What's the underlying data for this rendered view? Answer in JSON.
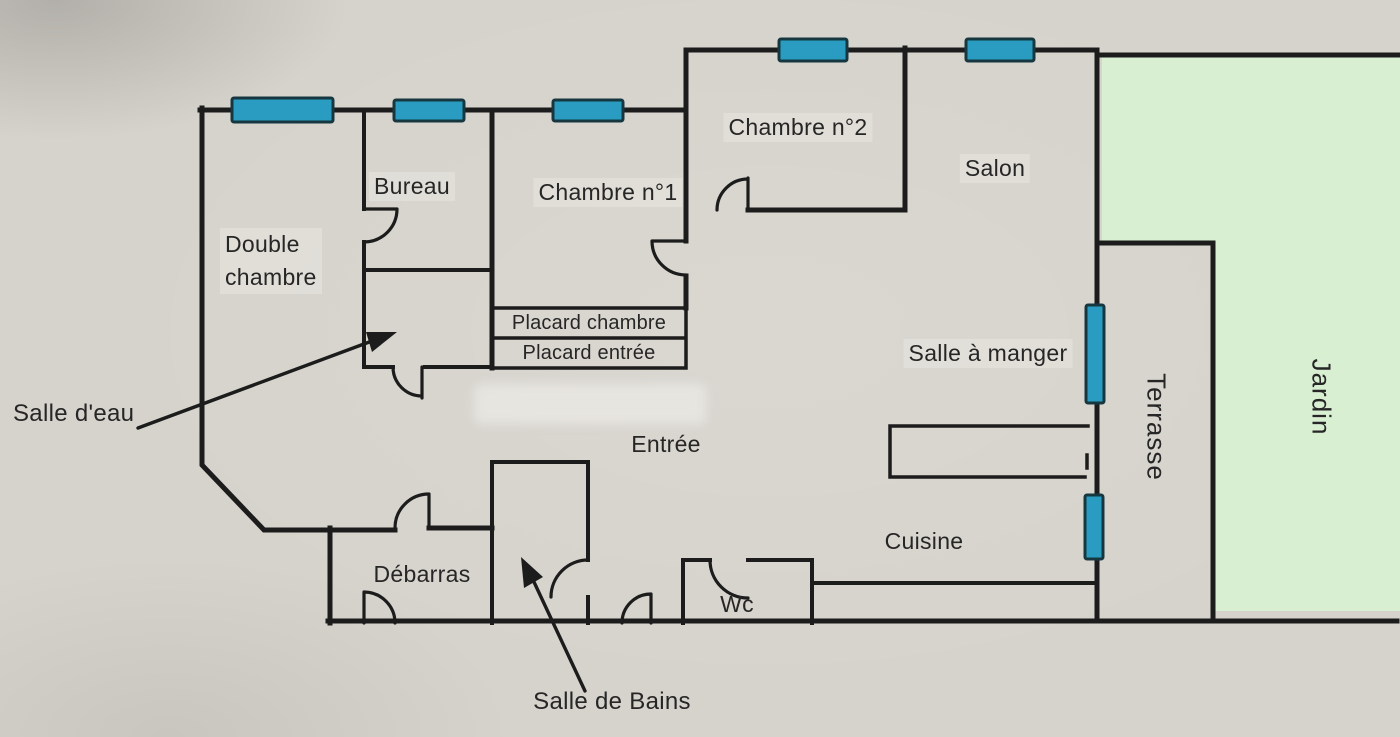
{
  "plan": {
    "rooms": {
      "double_chambre_line1": "Double",
      "double_chambre_line2": "chambre",
      "bureau": "Bureau",
      "chambre1": "Chambre n°1",
      "chambre2": "Chambre n°2",
      "salon": "Salon",
      "salle_a_manger": "Salle à manger",
      "entree": "Entrée",
      "cuisine": "Cuisine",
      "debarras": "Débarras",
      "wc": "Wc",
      "placard_chambre": "Placard chambre",
      "placard_entree": "Placard entrée"
    },
    "annotations": {
      "salle_deau": "Salle d'eau",
      "salle_de_bains": "Salle de Bains"
    },
    "outdoor": {
      "terrasse": "Terrasse",
      "jardin": "Jardin"
    }
  },
  "colors": {
    "paper": "#d6d3cc",
    "wall": "#1c1c1c",
    "window_fill": "#2a9cc1",
    "window_border": "#173740",
    "garden": "#d9efd2",
    "label": "#262626"
  }
}
